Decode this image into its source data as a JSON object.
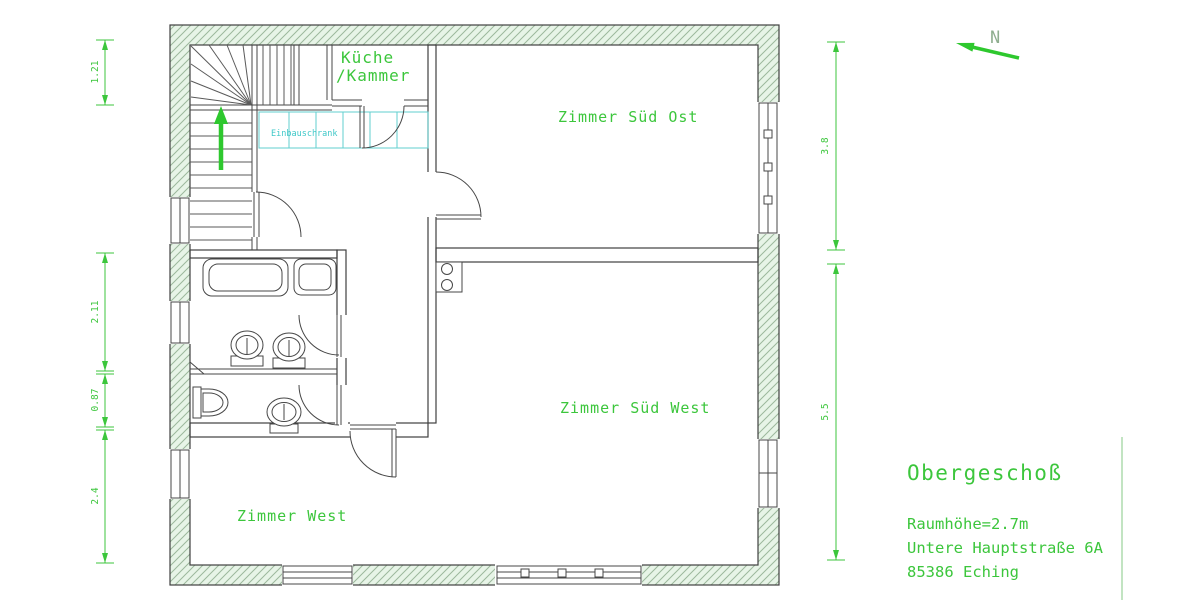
{
  "plan": {
    "north_label": "N",
    "rooms": {
      "kueche_line1": "Küche",
      "kueche_line2": "/Kammer",
      "sued_ost": "Zimmer Süd Ost",
      "sued_west": "Zimmer Süd West",
      "west": "Zimmer West",
      "einbauschrank": "Einbauschrank"
    },
    "dimensions": {
      "left": [
        "1.21",
        "2.11",
        "0.87",
        "2.4"
      ],
      "right": [
        "3.8",
        "5.5"
      ]
    },
    "title_block": {
      "floor": "Obergeschoß",
      "room_height": "Raumhöhe=2.7m",
      "address_line1": "Untere Hauptstraße 6A",
      "address_line2": "85386 Eching"
    },
    "colors": {
      "label_green": "#3cc63c",
      "cabinet_cyan": "#3fc8c8",
      "hatch_bg": "#e7f4e7",
      "hatch_line": "#9cb89c",
      "line_dark": "#474747",
      "north_gray_green": "#8fae8f",
      "stair_arrow_green": "#2ec82e"
    }
  }
}
